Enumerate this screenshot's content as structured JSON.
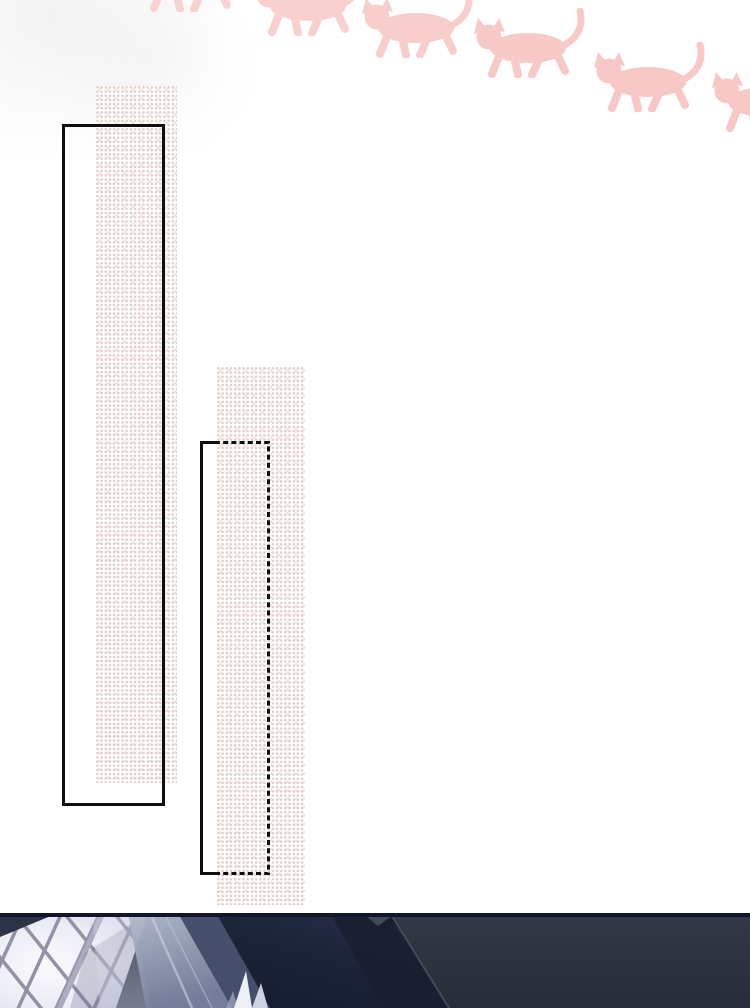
{
  "page": {
    "type": "comic-page",
    "width": 750,
    "height": 1008,
    "visible_text": "",
    "background": "#ffffff"
  },
  "colors": {
    "page_bg": "#ffffff",
    "cat_pink": "#f7c8c5",
    "halftone_dot": "#cdb0a6",
    "frame_black": "#0e0e0e",
    "window_light": "#f5f4fa",
    "lattice_bar": "#8d8ca4",
    "curtain_light": "#b7bdd0",
    "curtain_dark": "#4e5774",
    "wall_dark": "#2e3240",
    "navy_dark": "#171c30",
    "panel_top_band": "#11162a",
    "highlight_white": "#eef0f6"
  },
  "decorations": {
    "cats_row": {
      "icon": "cat-silhouette-icon",
      "count": 6,
      "description": "pink cat silhouettes walking to the left, stepping down diagonally from upper-left to lower-right, clipped at top and right edges"
    }
  },
  "panels": {
    "speech_strip_1": {
      "style": "halftone-dot vertical strip",
      "text": ""
    },
    "speech_strip_2": {
      "style": "halftone-dot vertical strip",
      "text": ""
    },
    "frame_1": {
      "border_style": "solid black rectangle outline"
    },
    "frame_2": {
      "border_style": "black rectangle outline, dashed on top/right/bottom"
    },
    "bottom_scene": {
      "description": "dark interior panel: bright diamond-lattice window at left, sheer curtains, deep navy walls with diagonal corner edge"
    }
  }
}
